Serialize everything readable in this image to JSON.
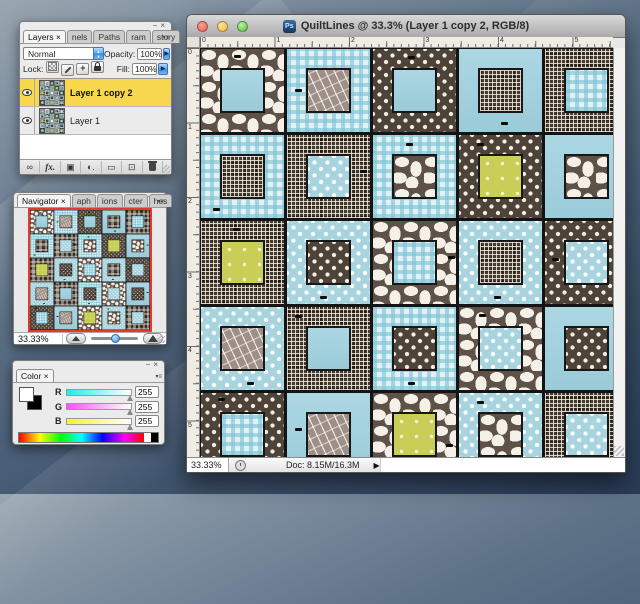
{
  "icons": {
    "minimize": "−",
    "close": "×",
    "panel_menu": "▾≡",
    "stepper_up": "▲",
    "stepper_down": "▼",
    "menu_arrow": "▶",
    "status_next": "▶"
  },
  "window": {
    "icon_text": "Ps",
    "title": "QuiltLines @ 33.3% (Layer 1 copy 2, RGB/8)",
    "ruler_h": [
      "0",
      "1",
      "2",
      "3",
      "4",
      "5"
    ],
    "ruler_v": [
      "0",
      "1",
      "2",
      "3",
      "4",
      "5"
    ],
    "status": {
      "zoom": "33.33%",
      "doc": "Doc: 8.15M/16.3M"
    }
  },
  "layers_panel": {
    "tabs": [
      "Layers ×",
      "nels",
      "Paths",
      "ram",
      "story"
    ],
    "blend_mode": "Normal",
    "opacity_label": "Opacity:",
    "opacity_value": "100%",
    "lock_label": "Lock:",
    "fill_label": "Fill:",
    "fill_value": "100%",
    "lock_icons": [
      {
        "name": "lock-transparency-icon",
        "cls": "lk-checker"
      },
      {
        "name": "lock-image-icon",
        "cls": "lk-brush"
      },
      {
        "name": "lock-position-icon",
        "cls": "lk-move",
        "glyph": "+"
      },
      {
        "name": "lock-all-icon",
        "cls": "lk-lock"
      }
    ],
    "layers": [
      {
        "name": "Layer 1 copy 2",
        "selected": true,
        "visible": true
      },
      {
        "name": "Layer 1",
        "selected": false,
        "visible": true
      }
    ],
    "bottom_icons": [
      {
        "name": "link-layers-icon",
        "glyph": "∞"
      },
      {
        "name": "layer-style-icon",
        "glyph": "fx.",
        "cls": "fxg"
      },
      {
        "name": "layer-mask-icon",
        "glyph": "▣"
      },
      {
        "name": "adjustment-layer-icon",
        "glyph": "◐."
      },
      {
        "name": "layer-group-icon",
        "glyph": "▭"
      },
      {
        "name": "new-layer-icon",
        "glyph": "⊡"
      },
      {
        "name": "delete-layer-icon",
        "glyph": "",
        "cls": "trash"
      }
    ]
  },
  "navigator_panel": {
    "tabs": [
      "Navigator ×",
      "aph",
      "ions",
      "cter",
      "hes"
    ],
    "zoom_value": "33.33%"
  },
  "color_panel": {
    "tabs": [
      "Color ×"
    ],
    "channels": [
      {
        "label": "R",
        "value": "255",
        "track_from": "#27e7f7"
      },
      {
        "label": "G",
        "value": "255",
        "track_from": "#f353f3"
      },
      {
        "label": "B",
        "value": "255",
        "track_from": "#f7f32a"
      }
    ]
  },
  "quilt": {
    "palette": {
      "brown": "#51463c",
      "cream": "#f4f0e7",
      "light_blue": "#a8d4e0",
      "gingham_base": "#e2f1f5",
      "tan": "#9e9086",
      "chartreuse": "#c9ce57",
      "seam": "#141414"
    },
    "blocks": [
      {
        "b": "organic",
        "c": "bsolid",
        "mx": 40,
        "my": 7
      },
      {
        "b": "gingham",
        "c": "tdash",
        "mx": 10,
        "my": 48
      },
      {
        "b": "bdots",
        "c": "bsolid",
        "mx": 42,
        "my": 8
      },
      {
        "b": "bsolid",
        "c": "plaid",
        "mx": 50,
        "my": 88
      },
      {
        "b": "plaid",
        "c": "gingham",
        "mx": 86,
        "my": 40
      },
      {
        "b": "gingham",
        "c": "plaid",
        "mx": 14,
        "my": 88
      },
      {
        "b": "plaid",
        "c": "bludots",
        "mx": 88,
        "my": 42
      },
      {
        "b": "gingham",
        "c": "organic",
        "mx": 40,
        "my": 10
      },
      {
        "b": "bdots",
        "c": "chart",
        "mx": 22,
        "my": 10
      },
      {
        "b": "bsolid",
        "c": "organic",
        "mx": 88,
        "my": 45
      },
      {
        "b": "plaid",
        "c": "chart",
        "mx": 38,
        "my": 8
      },
      {
        "b": "bludots",
        "c": "bdots",
        "mx": 40,
        "my": 90
      },
      {
        "b": "organic",
        "c": "gingham",
        "mx": 90,
        "my": 42
      },
      {
        "b": "bludots",
        "c": "plaid",
        "mx": 42,
        "my": 90
      },
      {
        "b": "bdots",
        "c": "bludots",
        "mx": 8,
        "my": 44
      },
      {
        "b": "bludots",
        "c": "tdash",
        "mx": 55,
        "my": 90
      },
      {
        "b": "plaid",
        "c": "bsolid",
        "mx": 10,
        "my": 10
      },
      {
        "b": "gingham",
        "c": "bdots",
        "mx": 42,
        "my": 90
      },
      {
        "b": "organic",
        "c": "bludots",
        "mx": 24,
        "my": 8
      },
      {
        "b": "bsolid",
        "c": "bdots",
        "mx": 88,
        "my": 42
      },
      {
        "b": "bdots",
        "c": "gingham",
        "mx": 20,
        "my": 6
      },
      {
        "b": "bsolid",
        "c": "tdash",
        "mx": 10,
        "my": 42
      },
      {
        "b": "organic",
        "c": "chart",
        "mx": 88,
        "my": 62
      },
      {
        "b": "bludots",
        "c": "organic",
        "mx": 22,
        "my": 10
      },
      {
        "b": "plaid",
        "c": "bludots",
        "mx": 42,
        "my": 88
      }
    ]
  }
}
